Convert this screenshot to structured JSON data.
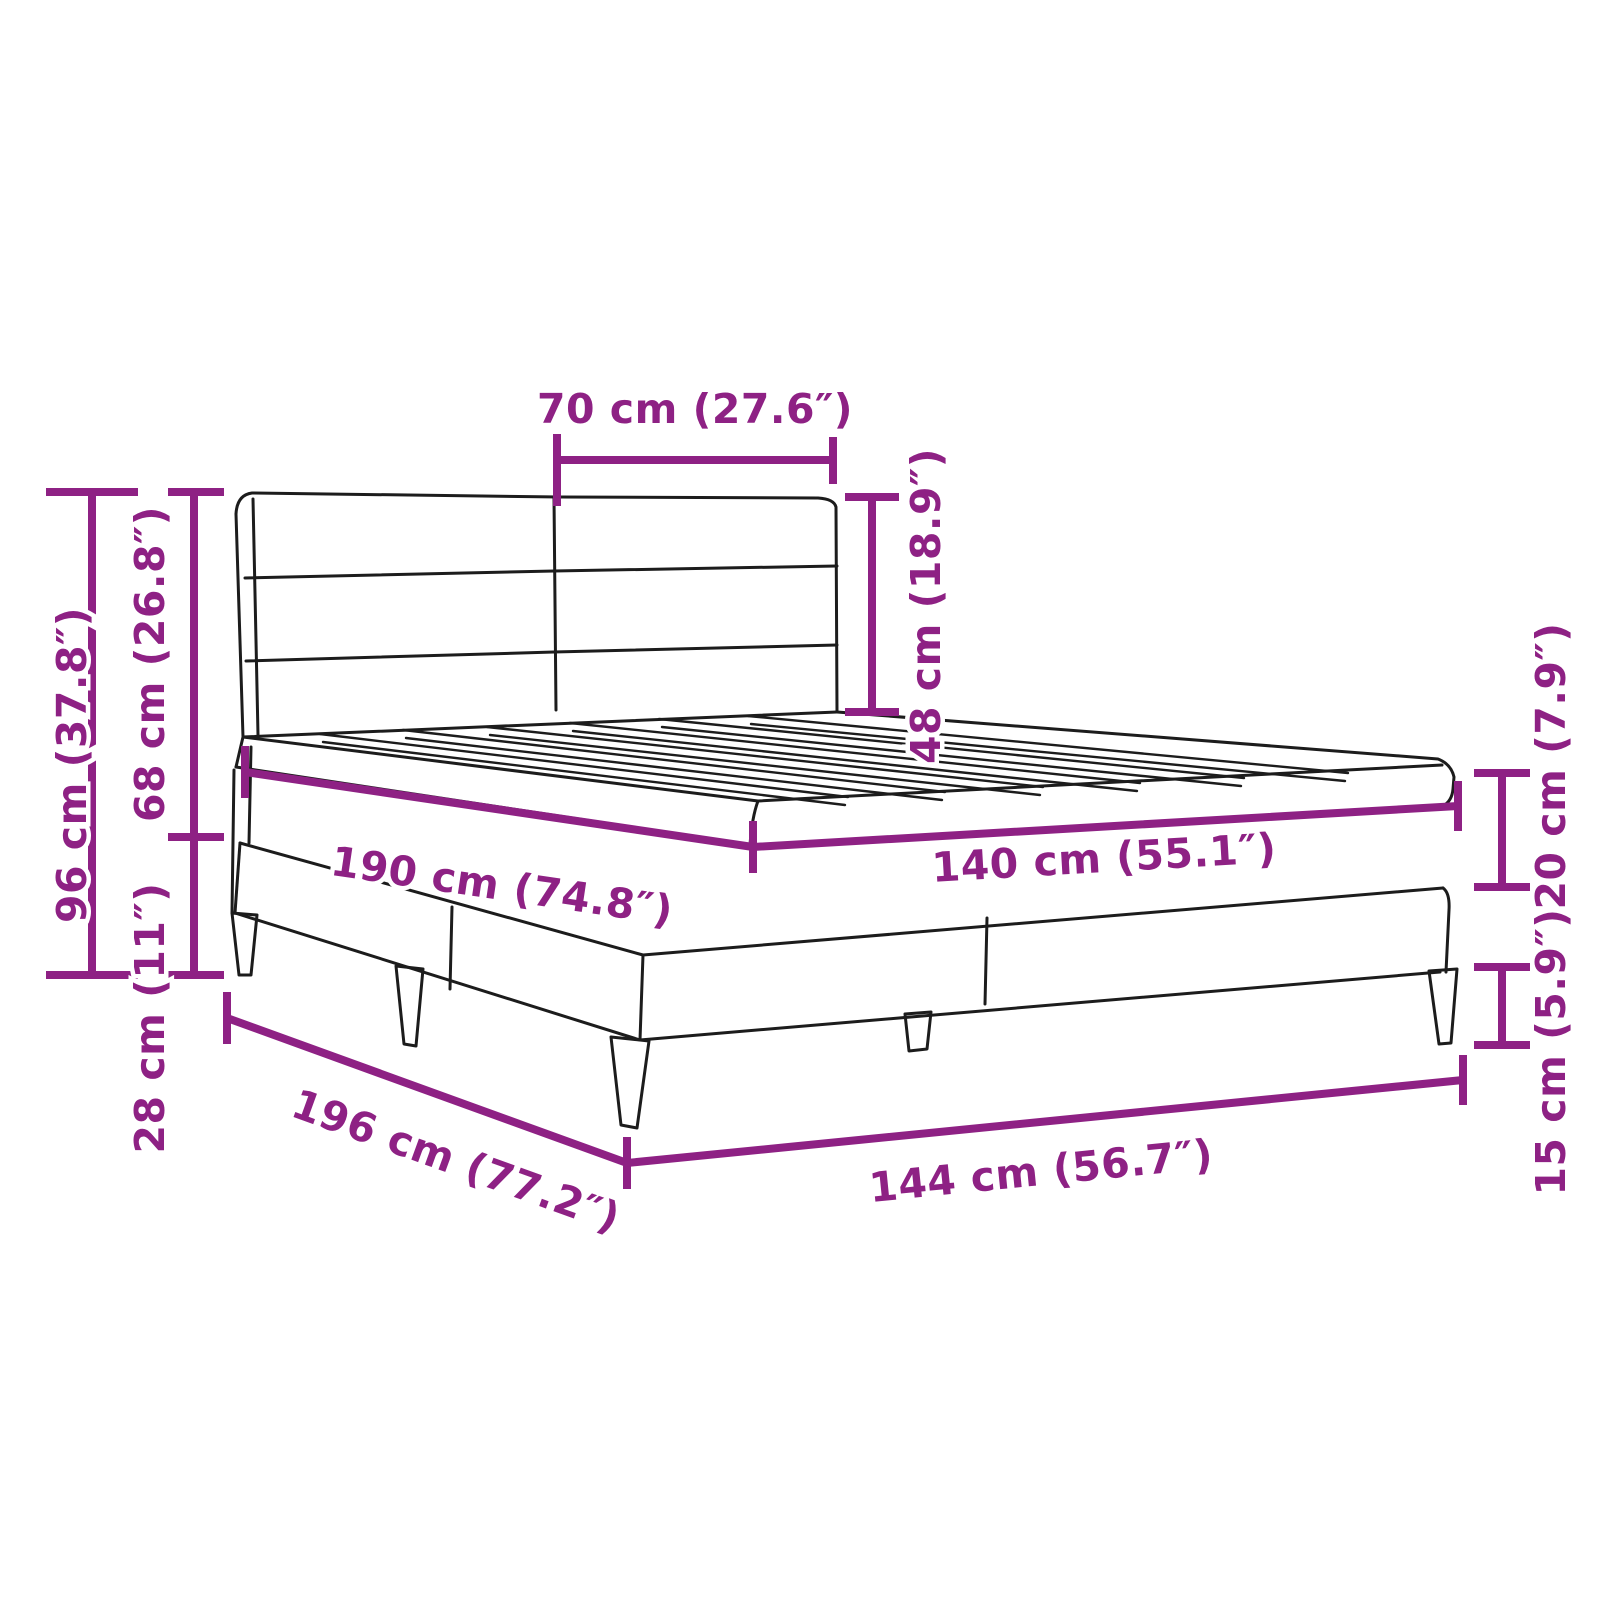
{
  "diagram": {
    "title": "Bed frame dimension diagram",
    "colors": {
      "accent": "#8E2184",
      "line": "#1C1C1C",
      "background": "#FFFFFF"
    },
    "labels": {
      "headboard_half_width": "70 cm (27.6″)",
      "headboard_panel_height": "48 cm (18.9″)",
      "total_height": "96 cm (37.8″)",
      "upper_height": "68 cm (26.8″)",
      "base_height": "28 cm (11″)",
      "sleeping_length": "190 cm (74.8″)",
      "sleeping_width": "140 cm (55.1″)",
      "platform_thickness": "20 cm (7.9″)",
      "leg_height": "15 cm (5.9″)",
      "outer_length": "196 cm (77.2″)",
      "outer_width": "144 cm (56.7″)"
    }
  }
}
